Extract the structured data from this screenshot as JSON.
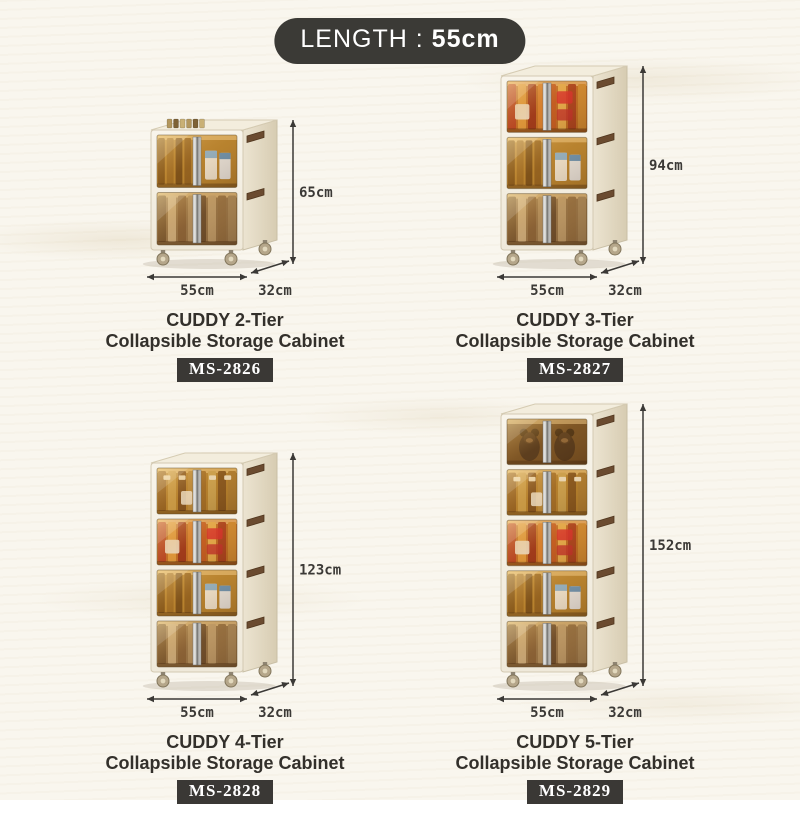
{
  "header": {
    "label": "LENGTH :",
    "value": "55cm"
  },
  "products": [
    {
      "title": "CUDDY 2-Tier",
      "subtitle": "Collapsible Storage Cabinet",
      "model": "MS-2826",
      "tiers": 2,
      "height_cm": 65,
      "height_label": "65cm",
      "width_label": "55cm",
      "depth_label": "32cm"
    },
    {
      "title": "CUDDY 3-Tier",
      "subtitle": "Collapsible Storage Cabinet",
      "model": "MS-2827",
      "tiers": 3,
      "height_cm": 94,
      "height_label": "94cm",
      "width_label": "55cm",
      "depth_label": "32cm"
    },
    {
      "title": "CUDDY 4-Tier",
      "subtitle": "Collapsible Storage Cabinet",
      "model": "MS-2828",
      "tiers": 4,
      "height_cm": 123,
      "height_label": "123cm",
      "width_label": "55cm",
      "depth_label": "32cm"
    },
    {
      "title": "CUDDY 5-Tier",
      "subtitle": "Collapsible Storage Cabinet",
      "model": "MS-2829",
      "tiers": 5,
      "height_cm": 152,
      "height_label": "152cm",
      "width_label": "55cm",
      "depth_label": "32cm"
    }
  ],
  "colors": {
    "badge_bg": "#3a3835",
    "header_bg": "#3b3a36",
    "text": "#33302b",
    "dimension": "#3b3936",
    "background": "#f9f6ee"
  }
}
